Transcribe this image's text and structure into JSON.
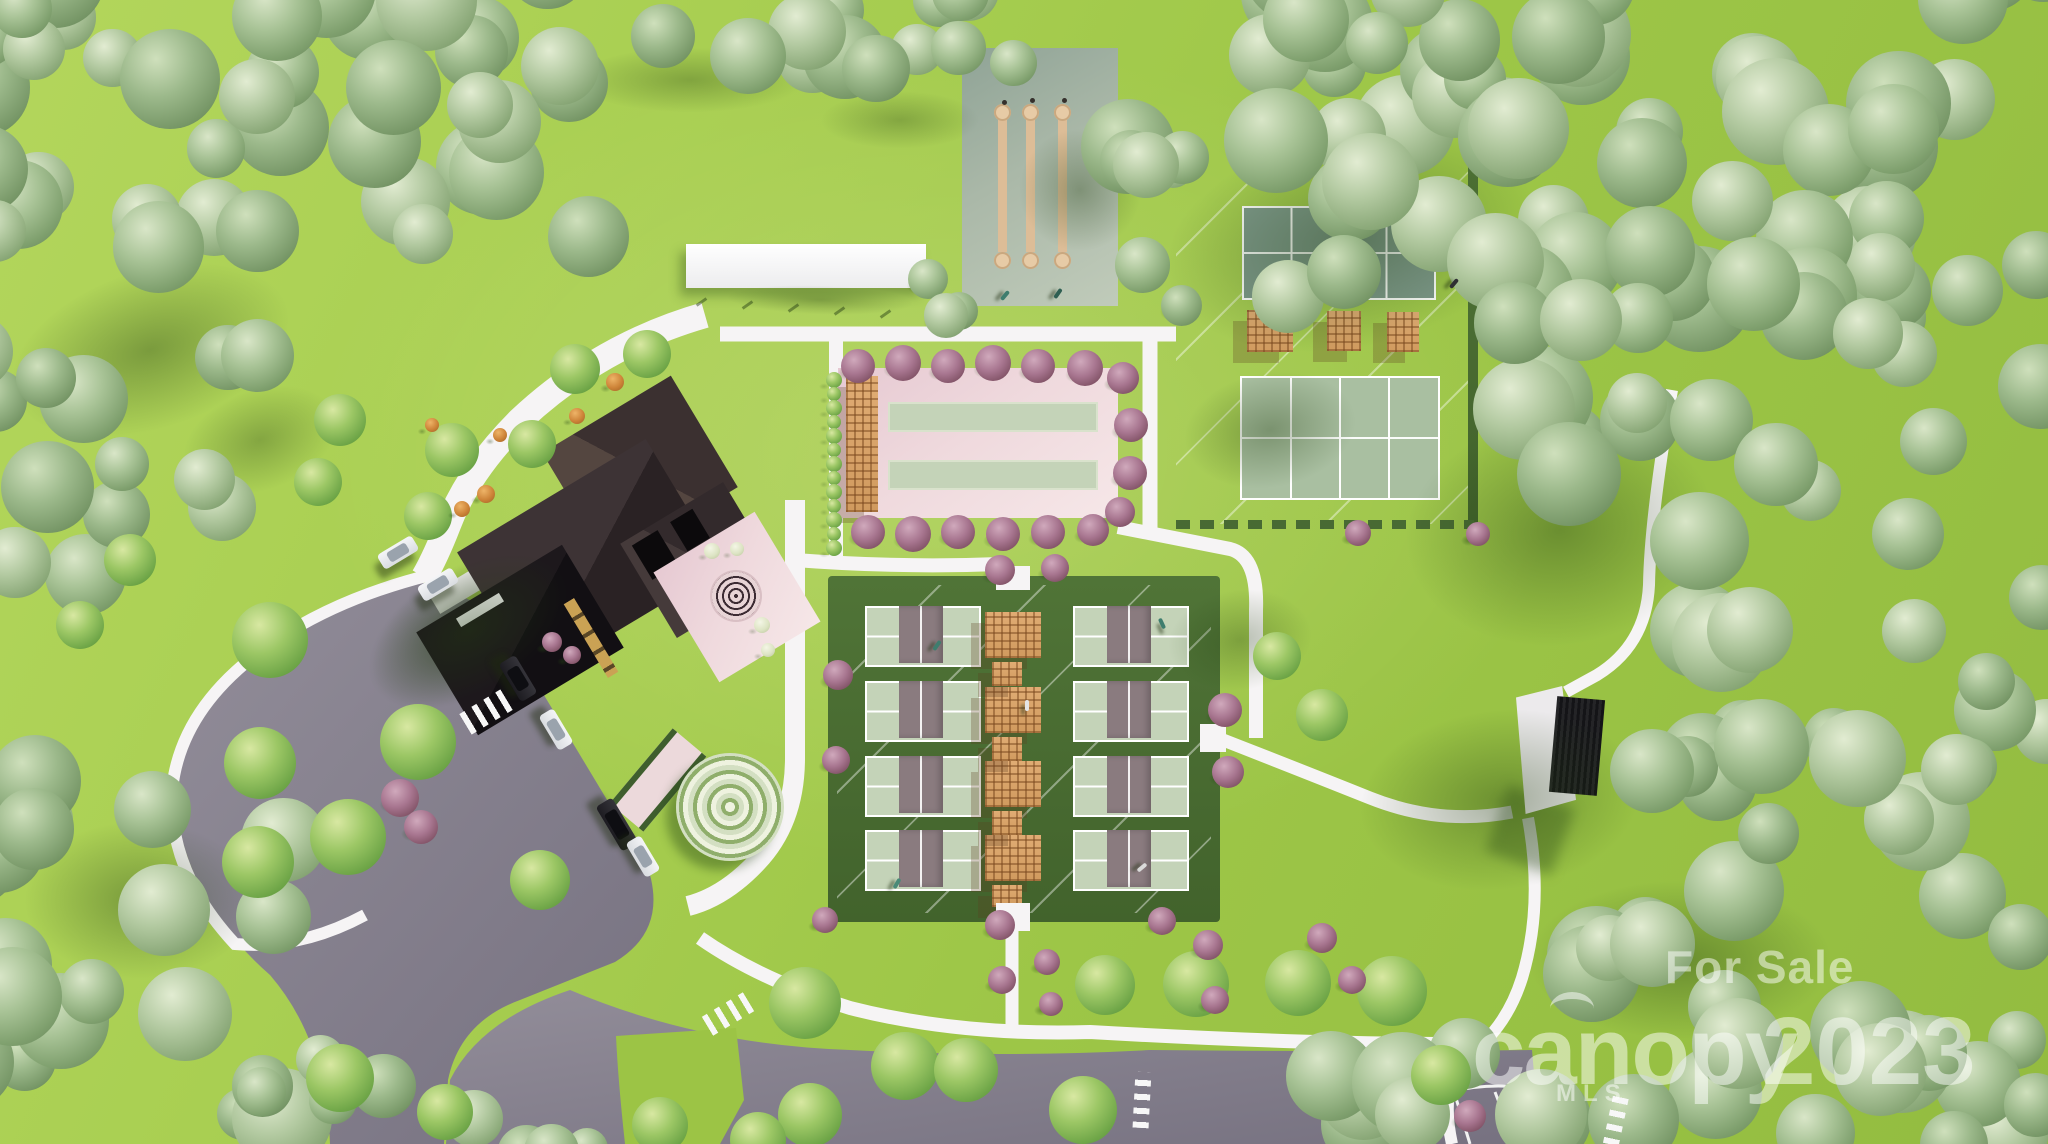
{
  "meta": {
    "description": "Aerial 3D rendering of a community amenity site plan for sale: clubhouse with dark roof, eight pickleball courts, sport courts with pergolas, bocce lanes, shuffleboard lanes, spiral garden, pavilion, parking lot with cars, walking paths and surrounding forest"
  },
  "watermark": {
    "for_sale": "For Sale",
    "logo": "canopy",
    "logo_sub": "MLS",
    "year": "2023"
  },
  "colors": {
    "grass": "#9dc647",
    "forest_green": "#8aa878",
    "road_gray": "#87828e",
    "path_white": "#f6f4f5",
    "pad_pink": "#efd9dd",
    "court_sage": "#c4d3b8",
    "court_teal": "#7e998b",
    "court_sage_lower": "#a9bfa1",
    "net_band": "#8a7b7f",
    "hedge_green": "#486a33",
    "roof_dark": "#332a2c",
    "roof_black": "#171318",
    "wood_tan": "#d9a873",
    "shuffle_pad": "#b7c4b2",
    "lane_tan": "#ddbd97",
    "watermark_white": "rgba(255,255,255,0.5)"
  },
  "scene": {
    "forests": [
      {
        "x": -30,
        "y": -40,
        "w": 620,
        "h": 300,
        "n": 36,
        "rmin": 28,
        "rmax": 52
      },
      {
        "x": -30,
        "y": 200,
        "w": 290,
        "h": 380,
        "n": 15,
        "rmin": 26,
        "rmax": 48
      },
      {
        "x": 540,
        "y": -35,
        "w": 440,
        "h": 105,
        "n": 12,
        "rmin": 24,
        "rmax": 42
      },
      {
        "x": 1090,
        "y": -40,
        "w": 980,
        "h": 190,
        "n": 34,
        "rmin": 30,
        "rmax": 56
      },
      {
        "x": 1260,
        "y": 90,
        "w": 800,
        "h": 230,
        "n": 26,
        "rmin": 30,
        "rmax": 54
      },
      {
        "x": 1500,
        "y": 270,
        "w": 560,
        "h": 230,
        "n": 16,
        "rmin": 28,
        "rmax": 52
      },
      {
        "x": 1690,
        "y": 450,
        "w": 370,
        "h": 330,
        "n": 15,
        "rmin": 28,
        "rmax": 52
      },
      {
        "x": 1630,
        "y": 730,
        "w": 430,
        "h": 230,
        "n": 13,
        "rmin": 28,
        "rmax": 50
      },
      {
        "x": 1310,
        "y": 920,
        "w": 750,
        "h": 250,
        "n": 28,
        "rmin": 28,
        "rmax": 52
      },
      {
        "x": -40,
        "y": 780,
        "w": 330,
        "h": 390,
        "n": 20,
        "rmin": 26,
        "rmax": 50
      },
      {
        "x": 930,
        "y": -30,
        "w": 130,
        "h": 95,
        "n": 4,
        "rmin": 20,
        "rmax": 34
      },
      {
        "x": 1095,
        "y": 60,
        "w": 120,
        "h": 270,
        "n": 6,
        "rmin": 20,
        "rmax": 36
      },
      {
        "x": 885,
        "y": 215,
        "w": 85,
        "h": 105,
        "n": 3,
        "rmin": 18,
        "rmax": 32
      },
      {
        "x": 250,
        "y": 1055,
        "w": 170,
        "h": 95,
        "n": 5,
        "rmin": 22,
        "rmax": 36
      },
      {
        "x": 470,
        "y": 1085,
        "w": 150,
        "h": 70,
        "n": 4,
        "rmin": 20,
        "rmax": 32
      }
    ],
    "lawn_trees": [
      [
        452,
        450,
        27
      ],
      [
        532,
        444,
        24
      ],
      [
        575,
        369,
        25
      ],
      [
        647,
        354,
        24
      ],
      [
        428,
        516,
        24
      ],
      [
        340,
        420,
        26
      ],
      [
        318,
        482,
        24
      ],
      [
        270,
        640,
        38
      ],
      [
        260,
        763,
        36
      ],
      [
        130,
        560,
        26
      ],
      [
        80,
        625,
        24
      ],
      [
        418,
        742,
        38
      ],
      [
        348,
        837,
        38
      ],
      [
        540,
        880,
        30
      ],
      [
        258,
        862,
        36
      ],
      [
        340,
        1078,
        34
      ],
      [
        445,
        1112,
        28
      ],
      [
        1105,
        985,
        30
      ],
      [
        1196,
        984,
        33
      ],
      [
        1298,
        983,
        33
      ],
      [
        1392,
        991,
        35
      ],
      [
        1441,
        1075,
        30
      ],
      [
        805,
        1003,
        36
      ],
      [
        905,
        1066,
        34
      ],
      [
        966,
        1070,
        32
      ],
      [
        1083,
        1110,
        34
      ],
      [
        810,
        1115,
        32
      ],
      [
        660,
        1125,
        28
      ],
      [
        758,
        1140,
        28
      ],
      [
        1277,
        656,
        24
      ],
      [
        1322,
        715,
        26
      ]
    ],
    "purple_trees": [
      [
        858,
        366,
        17
      ],
      [
        903,
        363,
        18
      ],
      [
        948,
        366,
        17
      ],
      [
        993,
        363,
        18
      ],
      [
        1038,
        366,
        17
      ],
      [
        1085,
        368,
        18
      ],
      [
        868,
        532,
        17
      ],
      [
        913,
        534,
        18
      ],
      [
        958,
        532,
        17
      ],
      [
        1003,
        534,
        17
      ],
      [
        1048,
        532,
        17
      ],
      [
        1093,
        530,
        16
      ],
      [
        1120,
        512,
        15
      ],
      [
        1123,
        378,
        16
      ],
      [
        1131,
        425,
        17
      ],
      [
        1130,
        473,
        17
      ],
      [
        1000,
        570,
        15
      ],
      [
        1055,
        568,
        14
      ],
      [
        1225,
        710,
        17
      ],
      [
        1228,
        772,
        16
      ],
      [
        838,
        675,
        15
      ],
      [
        836,
        760,
        14
      ],
      [
        825,
        920,
        13
      ],
      [
        1000,
        925,
        15
      ],
      [
        1002,
        980,
        14
      ],
      [
        1047,
        962,
        13
      ],
      [
        1051,
        1004,
        12
      ],
      [
        1162,
        921,
        14
      ],
      [
        1208,
        945,
        15
      ],
      [
        1215,
        1000,
        14
      ],
      [
        1322,
        938,
        15
      ],
      [
        1352,
        980,
        14
      ],
      [
        1358,
        533,
        13
      ],
      [
        1478,
        534,
        12
      ],
      [
        1470,
        1116,
        16
      ],
      [
        400,
        798,
        19
      ],
      [
        421,
        827,
        17
      ],
      [
        552,
        642,
        10
      ],
      [
        572,
        655,
        9
      ]
    ],
    "orange_shrubs": [
      [
        615,
        382,
        9
      ],
      [
        577,
        416,
        8
      ],
      [
        486,
        494,
        9
      ],
      [
        462,
        509,
        8
      ],
      [
        500,
        435,
        7
      ],
      [
        432,
        425,
        7
      ]
    ],
    "white_shrubs": [
      [
        712,
        551,
        8
      ],
      [
        737,
        549,
        7
      ],
      [
        762,
        625,
        8
      ],
      [
        768,
        650,
        7
      ]
    ],
    "vine_row": {
      "x": 834,
      "y0": 380,
      "y1": 548,
      "step": 14,
      "r": 7
    },
    "cars": [
      [
        398,
        552,
        -31,
        "sedan_white",
        40,
        17
      ],
      [
        438,
        584,
        -31,
        "sedan_white",
        40,
        17
      ],
      [
        518,
        678,
        59,
        "suv_dark",
        44,
        19
      ],
      [
        556,
        729,
        59,
        "sedan_white",
        40,
        17
      ],
      [
        617,
        824,
        59,
        "pickup_dark",
        52,
        19
      ],
      [
        643,
        856,
        59,
        "sedan_white",
        40,
        17
      ]
    ],
    "crosswalks": [
      [
        486,
        712,
        24,
        48,
        59
      ],
      [
        728,
        1014,
        22,
        48,
        59
      ],
      [
        1142,
        1100,
        16,
        56,
        3
      ],
      [
        1616,
        1120,
        16,
        50,
        12
      ]
    ],
    "figures": [
      [
        1452,
        278,
        40,
        "#2f2f33"
      ],
      [
        935,
        640,
        35,
        "#3e7d6e"
      ],
      [
        1160,
        618,
        -25,
        "#3e7d6e"
      ],
      [
        895,
        878,
        30,
        "#4a8a78"
      ],
      [
        1025,
        700,
        0,
        "#e4e4e4"
      ],
      [
        1140,
        862,
        50,
        "#dadada"
      ],
      [
        1003,
        290,
        40,
        "#3e7d6e"
      ],
      [
        1056,
        288,
        35,
        "#2f5f52"
      ]
    ],
    "shadow_blobs": [
      [
        150,
        350,
        400,
        220,
        -18,
        0.38
      ],
      [
        690,
        80,
        320,
        90,
        0,
        0.3
      ],
      [
        1350,
        240,
        520,
        300,
        -12,
        0.4
      ],
      [
        1560,
        530,
        430,
        320,
        -8,
        0.42
      ],
      [
        1500,
        800,
        390,
        250,
        -6,
        0.38
      ],
      [
        1680,
        960,
        420,
        220,
        0,
        0.4
      ],
      [
        1080,
        190,
        170,
        170,
        0,
        0.35
      ],
      [
        470,
        630,
        300,
        170,
        -31,
        0.42
      ],
      [
        140,
        900,
        320,
        220,
        0,
        0.38
      ],
      [
        260,
        440,
        220,
        140,
        -20,
        0.3
      ],
      [
        900,
        120,
        220,
        80,
        0,
        0.28
      ],
      [
        1270,
        430,
        240,
        160,
        -10,
        0.35
      ],
      [
        820,
        300,
        260,
        40,
        2,
        0.3
      ],
      [
        1240,
        640,
        200,
        140,
        -8,
        0.3
      ]
    ],
    "shuffleboard": {
      "pad": [
        962,
        48,
        156,
        258
      ],
      "lanes_x": [
        998,
        1026,
        1058
      ],
      "lane_w": 9,
      "lane_y0": 112,
      "lane_y1": 252,
      "dots": [
        [
          1002,
          100
        ],
        [
          1030,
          98
        ],
        [
          1062,
          98
        ]
      ]
    },
    "bocce": {
      "lanes": [
        [
          888,
          402,
          210,
          30
        ],
        [
          888,
          460,
          210,
          30
        ]
      ]
    },
    "tennis": {
      "pergolas": [
        [
          1247,
          310,
          46,
          42
        ],
        [
          1327,
          311,
          34,
          40
        ],
        [
          1387,
          312,
          32,
          40
        ]
      ]
    },
    "pickleball": {
      "cols_x": [
        865,
        1073
      ],
      "rows_y": [
        606,
        681,
        756,
        830
      ],
      "court_w": 112,
      "court_h": 57,
      "band_w": 44,
      "pergolas": [
        [
          985,
          612,
          56,
          46
        ],
        [
          985,
          687,
          56,
          46
        ],
        [
          985,
          761,
          56,
          46
        ],
        [
          985,
          835,
          56,
          46
        ]
      ],
      "sublattice": [
        [
          992,
          662,
          30,
          24
        ],
        [
          992,
          737,
          30,
          24
        ],
        [
          992,
          811,
          30,
          24
        ],
        [
          992,
          885,
          30,
          22
        ]
      ],
      "gaps": [
        [
          996,
          566,
          34,
          24
        ],
        [
          996,
          903,
          34,
          28
        ],
        [
          1200,
          724,
          26,
          28
        ]
      ]
    },
    "canopy_posts": [
      [
        700,
        296
      ],
      [
        746,
        299
      ],
      [
        792,
        302
      ],
      [
        838,
        305
      ],
      [
        884,
        308
      ]
    ]
  }
}
